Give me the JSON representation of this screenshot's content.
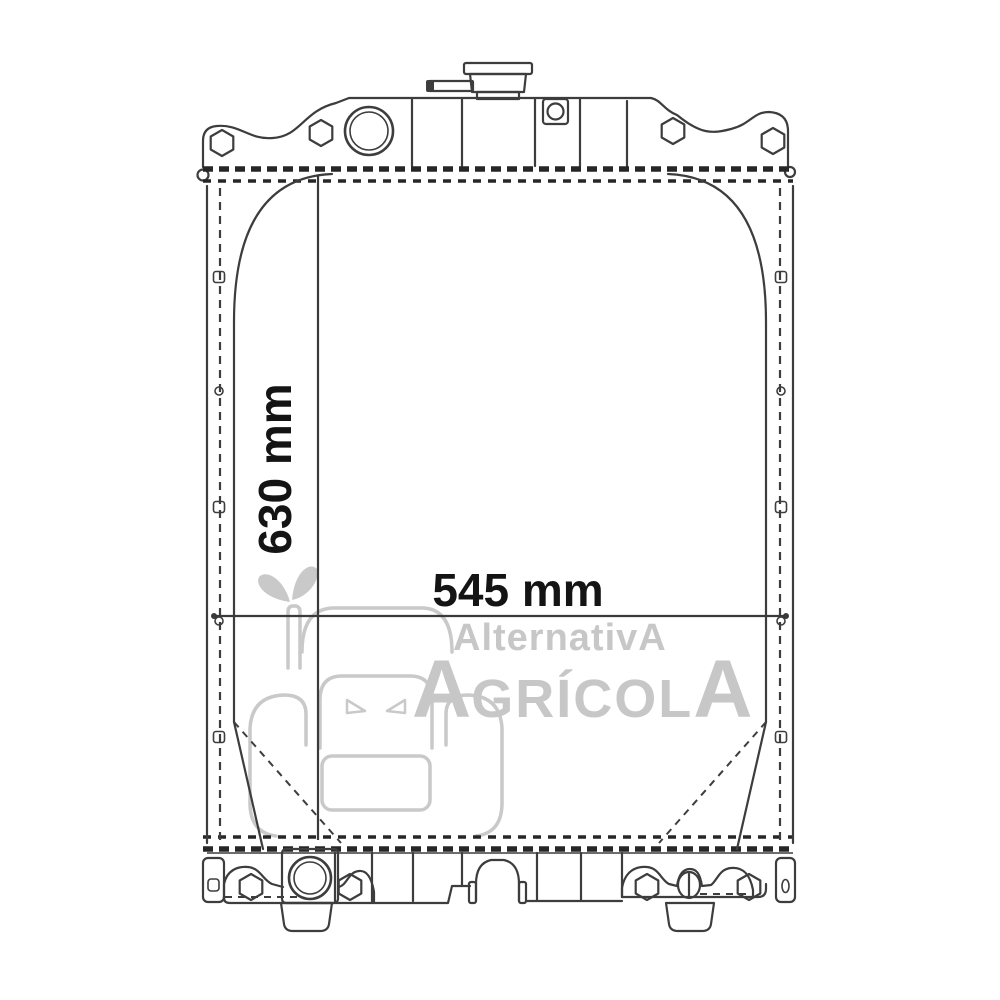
{
  "colors": {
    "background": "#ffffff",
    "line": "#3d3d3d",
    "joint_line": "#262626",
    "dimension_line": "#3a3a3a",
    "dimension_text": "#141414",
    "watermark": "#c7c7c7"
  },
  "dimensions": {
    "height_label": "630 mm",
    "width_label": "545 mm"
  },
  "watermark": {
    "line1": "AlternativA",
    "line2_first": "A",
    "line2_middle": "GRÍCOL",
    "line2_last": "A"
  }
}
